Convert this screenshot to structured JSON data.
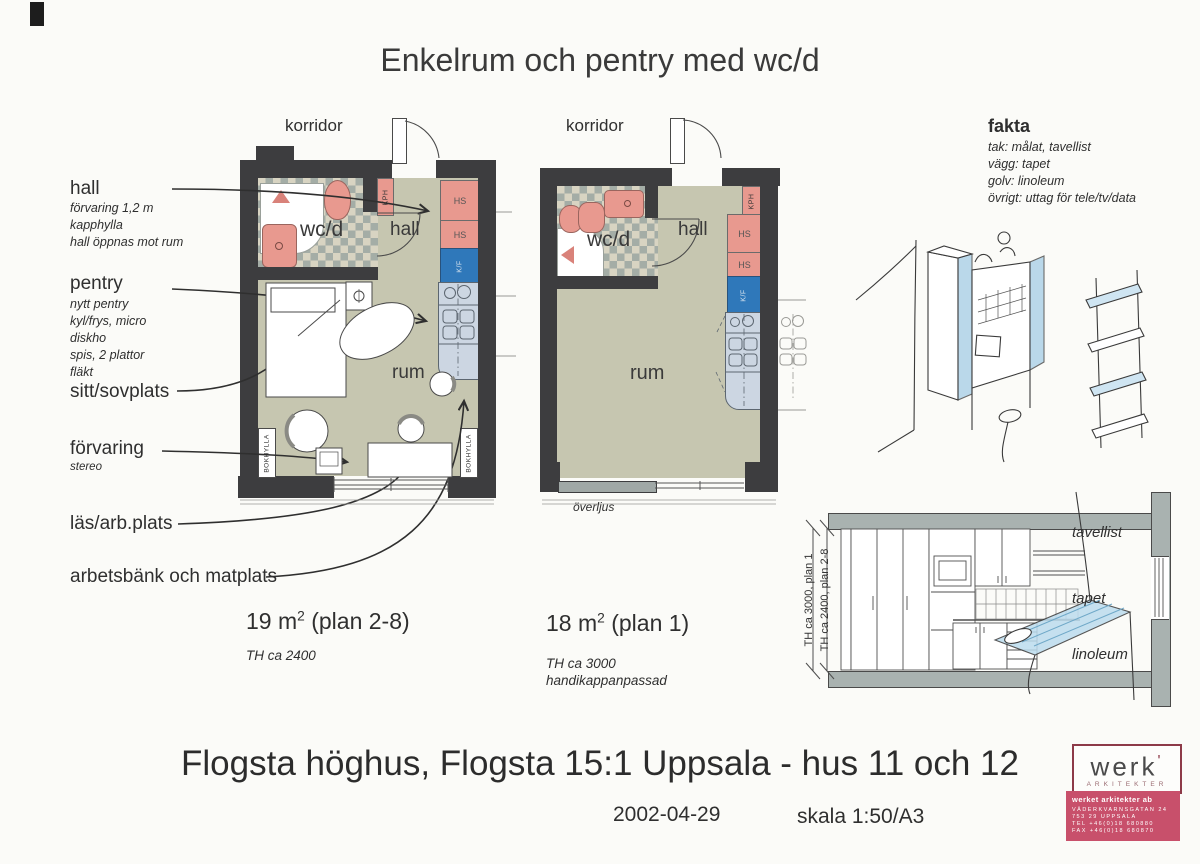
{
  "title": "Enkelrum och pentry med wc/d",
  "labels": {
    "hall": {
      "head": "hall",
      "line1": "förvaring 1,2 m",
      "line2": "kapphylla",
      "line3": "hall öppnas mot rum"
    },
    "pentry": {
      "head": "pentry",
      "line1": "nytt pentry",
      "line2": "kyl/frys, micro",
      "line3": "diskho",
      "line4": "spis, 2 plattor",
      "line5": "fläkt"
    },
    "sitt": {
      "head": "sitt/sovplats"
    },
    "forvaring": {
      "head": "förvaring",
      "line1": "stereo"
    },
    "las": {
      "head": "läs/arb.plats"
    },
    "arbetsbank": {
      "head": "arbetsbänk och matplats"
    }
  },
  "fakta": {
    "head": "fakta",
    "line1": "tak: målat, tavellist",
    "line2": "vägg: tapet",
    "line3": "golv: linoleum",
    "line4": "övrigt: uttag för tele/tv/data"
  },
  "plan1": {
    "korridor": "korridor",
    "wcd": "wc/d",
    "hall": "hall",
    "rum": "rum",
    "kph": "KPH",
    "hs_upper": "HS",
    "hs_lower": "HS",
    "kf": "K/F",
    "bokhylla_left": "BOKHYLLA",
    "bokhylla_right": "BOKHYLLA",
    "area_val": "19 m",
    "area_sup": "2",
    "area_rest": " (plan 2-8)",
    "th": "TH ca 2400"
  },
  "plan2": {
    "korridor": "korridor",
    "wcd": "wc/d",
    "hall": "hall",
    "rum": "rum",
    "kph": "KPH",
    "hs_upper": "HS",
    "hs_lower": "HS",
    "kf": "K/F",
    "overljus": "överljus",
    "area_val": "18 m",
    "area_sup": "2",
    "area_rest": " (plan 1)",
    "th": "TH ca 3000",
    "extra": "handikappanpassad"
  },
  "section": {
    "tavellist": "tavellist",
    "tapet": "tapet",
    "linoleum": "linoleum",
    "dim_inner": "TH ca 3000, plan 1",
    "dim_outer": "TH ca 2400, plan 2-8"
  },
  "footer": {
    "project": "Flogsta höghus, Flogsta 15:1 Uppsala - hus 11 och 12",
    "date": "2002-04-29",
    "scale": "skala 1:50/A3"
  },
  "logo": {
    "word": "werk",
    "mark": "'",
    "sub": "ARKITEKTER",
    "row0": "werket arkitekter ab",
    "row1": "VÄDERKVARNSGATAN 24",
    "row2": "753 29 UPPSALA",
    "row3": "TEL +46(0)18 680880",
    "row4": "FAX +46(0)18 680870"
  },
  "colors": {
    "wall": "#3d3d3f",
    "floor": "#c6c6b0",
    "tile": "#d8d4c2",
    "tile_square": "#a4ada6",
    "pink": "#e8998f",
    "blue": "#2f78ba",
    "counter": "#ccd6e2",
    "slab": "#a9b2b0",
    "logo_red": "#c8506b",
    "ink": "#2f2f2f"
  }
}
